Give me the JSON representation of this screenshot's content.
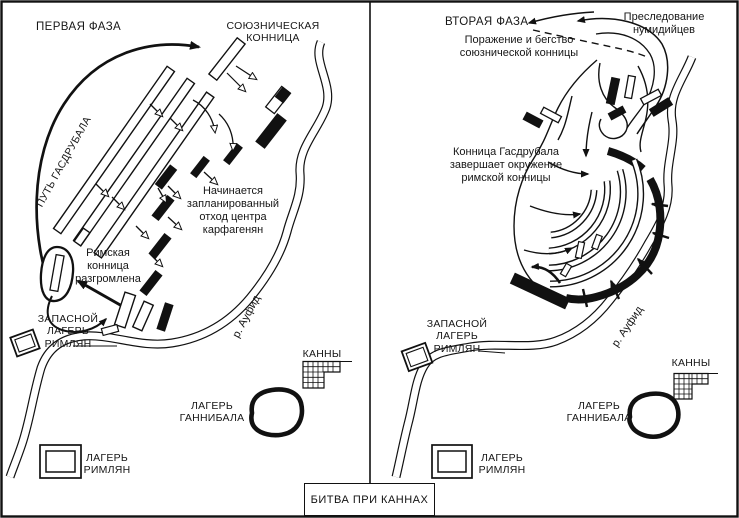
{
  "colors": {
    "ink": "#111111",
    "paper": "#ffffff"
  },
  "caption": {
    "label": "БИТВА ПРИ КАННАХ"
  },
  "phase1": {
    "title": "ПЕРВАЯ ФАЗА",
    "allied_cavalry": "СОЮЗНИЧЕСКАЯ\nКОННИЦА",
    "hasdrubal_path": "ПУТЬ ГАСДРУБАЛА",
    "center_retreat": "Начинается\nзапланированный\nотход центра\nкарфагенян",
    "roman_cavalry_defeated": "Римская\nконница\nразгромлена",
    "reserve_camp": "ЗАПАСНОЙ\nЛАГЕРЬ\nРИМЛЯН",
    "river": "р. Ауфид",
    "cannae": "КАННЫ",
    "hannibal_camp": "ЛАГЕРЬ\nГАННИБАЛА",
    "roman_camp": "ЛАГЕРЬ\nРИМЛЯН"
  },
  "phase2": {
    "title": "ВТОРАЯ ФАЗА",
    "numidian_pursuit": "Преследование\nнумидийцев",
    "allied_cavalry_flight": "Поражение и бегство\nсоюзнической конницы",
    "encirclement": "Конница Гасдрубала\nзавершает окружение\nримской конницы",
    "reserve_camp": "ЗАПАСНОЙ\nЛАГЕРЬ\nРИМЛЯН",
    "river": "р. Ауфид",
    "cannae": "КАННЫ",
    "hannibal_camp": "ЛАГЕРЬ\nГАННИБАЛА",
    "roman_camp": "ЛАГЕРЬ\nРИМЛЯН"
  }
}
